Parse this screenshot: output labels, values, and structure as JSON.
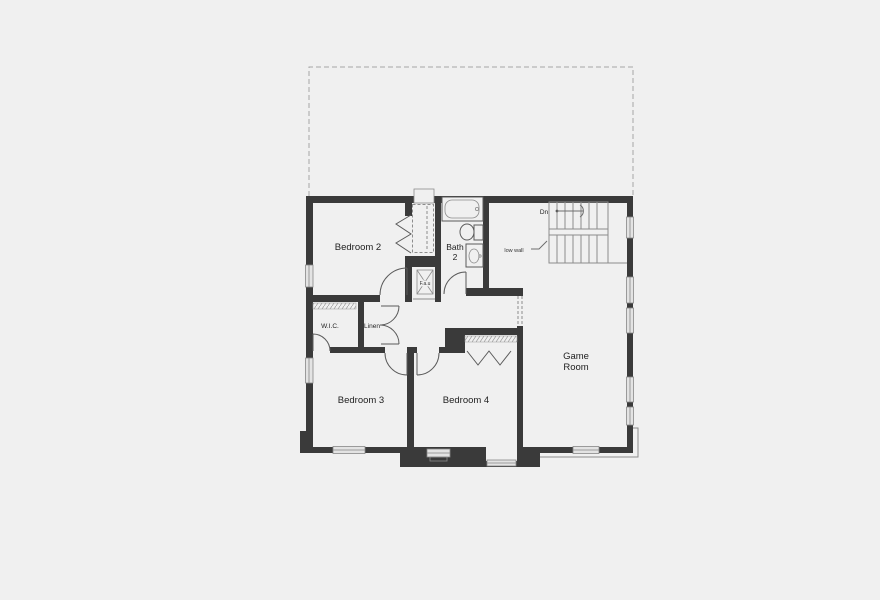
{
  "floor_plan": {
    "labels": {
      "bedroom2": "Bedroom 2",
      "bath_line1": "Bath",
      "bath_line2": "2",
      "wic": "W.I.C.",
      "linen": "Linen",
      "fau": "F.a.u",
      "bedroom3": "Bedroom 3",
      "bedroom4": "Bedroom 4",
      "game_line1": "Game",
      "game_line2": "Room",
      "stairs_down": "Dn",
      "low_wall": "low wall"
    },
    "colors": {
      "background": "#f0f0f0",
      "wall": "#3a3a3a",
      "thin_line": "#8c8c8c",
      "window_fill": "#e3e3e3",
      "dashed_line": "#a6a6a6",
      "text": "#222222"
    }
  }
}
